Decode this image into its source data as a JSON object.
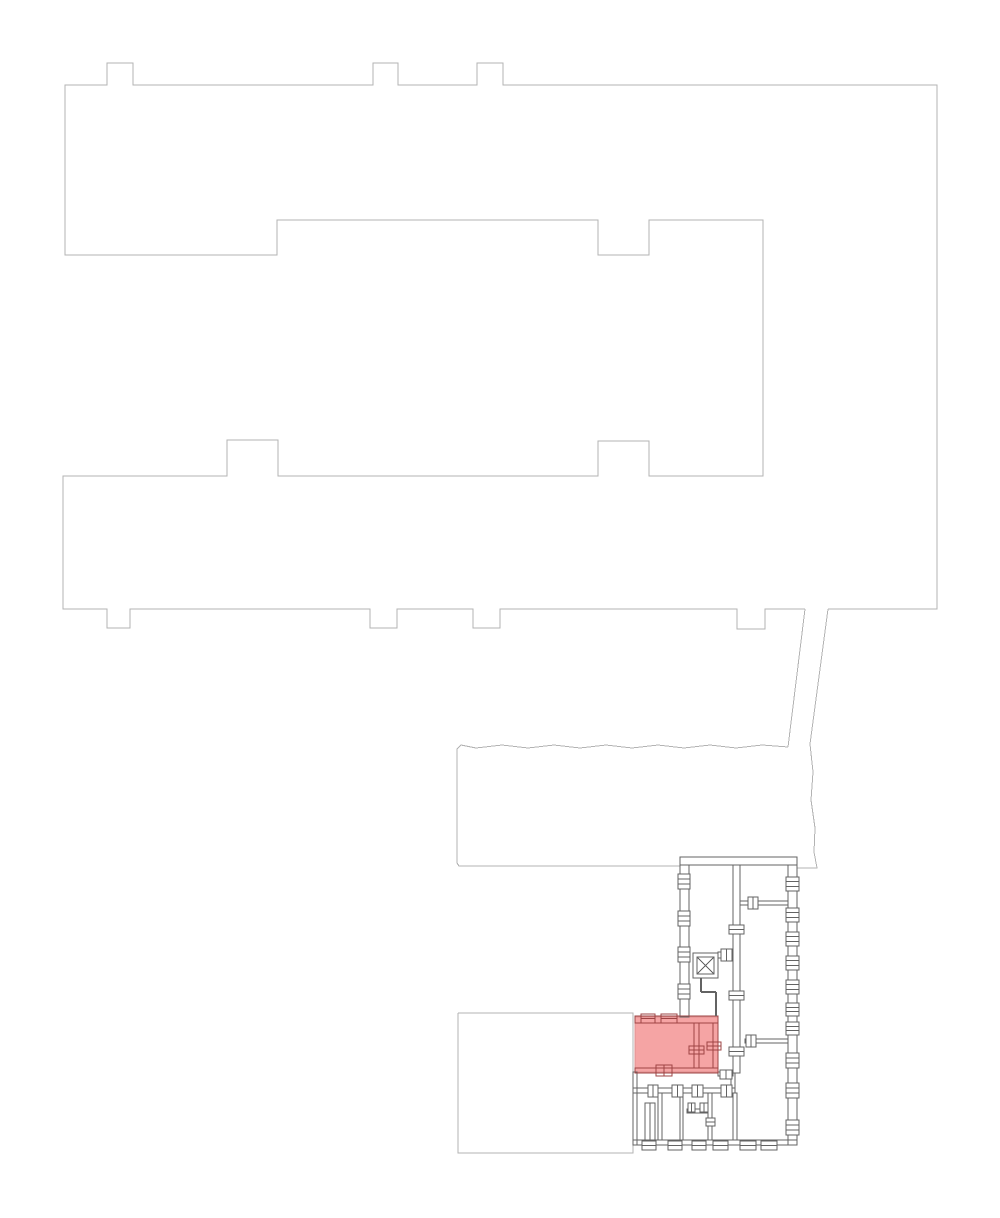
{
  "plan": {
    "canvas": {
      "width": 1000,
      "height": 1218,
      "background": "#ffffff"
    },
    "colors": {
      "outline": "#b3b3b3",
      "wall": "#636363",
      "highlight_wall": "#9e4444",
      "highlight_fill": "#f5a4a4",
      "highlight_edge": "#dd8f8f",
      "background": "#ffffff"
    },
    "outlines": [
      {
        "name": "main-building-outline",
        "points": [
          [
            828,
            609
          ],
          [
            937,
            609
          ],
          [
            937,
            85
          ],
          [
            503,
            85
          ],
          [
            503,
            63
          ],
          [
            477,
            63
          ],
          [
            477,
            85
          ],
          [
            398,
            85
          ],
          [
            398,
            63
          ],
          [
            373,
            63
          ],
          [
            373,
            85
          ],
          [
            133,
            85
          ],
          [
            133,
            63
          ],
          [
            107,
            63
          ],
          [
            107,
            85
          ],
          [
            65,
            85
          ],
          [
            65,
            255
          ],
          [
            277,
            255
          ],
          [
            277,
            220
          ],
          [
            598,
            220
          ],
          [
            598,
            255
          ],
          [
            649,
            255
          ],
          [
            649,
            220
          ],
          [
            763,
            220
          ],
          [
            763,
            476
          ],
          [
            649,
            476
          ],
          [
            649,
            441
          ],
          [
            598,
            441
          ],
          [
            598,
            476
          ],
          [
            278,
            476
          ],
          [
            278,
            440
          ],
          [
            227,
            440
          ],
          [
            227,
            476
          ],
          [
            63,
            476
          ],
          [
            63,
            609
          ],
          [
            107,
            609
          ],
          [
            107,
            628
          ],
          [
            130,
            628
          ],
          [
            130,
            609
          ],
          [
            370,
            609
          ],
          [
            370,
            628
          ],
          [
            397,
            628
          ],
          [
            397,
            609
          ],
          [
            473,
            609
          ],
          [
            473,
            628
          ],
          [
            500,
            628
          ],
          [
            500,
            609
          ],
          [
            737,
            609
          ],
          [
            737,
            629
          ],
          [
            765,
            629
          ],
          [
            765,
            609
          ],
          [
            805,
            609
          ]
        ]
      },
      {
        "name": "connector-left-line",
        "points": [
          [
            805,
            609
          ],
          [
            788,
            747
          ]
        ]
      },
      {
        "name": "connector-right-line",
        "points": [
          [
            828,
            609
          ],
          [
            810,
            744
          ]
        ]
      },
      {
        "name": "hall-outline",
        "points": [
          [
            788,
            747
          ],
          [
            762,
            745
          ],
          [
            736,
            748
          ],
          [
            710,
            745
          ],
          [
            684,
            748
          ],
          [
            658,
            745
          ],
          [
            632,
            748
          ],
          [
            606,
            745
          ],
          [
            580,
            748
          ],
          [
            554,
            745
          ],
          [
            528,
            748
          ],
          [
            502,
            745
          ],
          [
            476,
            748
          ],
          [
            461,
            745
          ],
          [
            457,
            749
          ],
          [
            457,
            863
          ],
          [
            459,
            866
          ],
          [
            680,
            866
          ]
        ]
      },
      {
        "name": "hall-right-edge",
        "points": [
          [
            810,
            744
          ],
          [
            813,
            772
          ],
          [
            811,
            800
          ],
          [
            815,
            828
          ],
          [
            814,
            852
          ],
          [
            817,
            868
          ],
          [
            797,
            868
          ]
        ]
      },
      {
        "name": "annex-outline",
        "points": [
          [
            458,
            1013
          ],
          [
            633,
            1013
          ],
          [
            633,
            1153
          ],
          [
            458,
            1153
          ],
          [
            458,
            1013
          ]
        ]
      }
    ],
    "walls": [
      {
        "name": "plan-top-wall",
        "x": 680,
        "y": 857,
        "w": 117,
        "h": 8
      },
      {
        "name": "plan-left-wall",
        "x": 680,
        "y": 865,
        "w": 9,
        "h": 152
      },
      {
        "name": "plan-right-wall",
        "x": 788,
        "y": 865,
        "w": 9,
        "h": 280
      },
      {
        "name": "plan-interior-wall",
        "x": 733,
        "y": 865,
        "w": 7,
        "h": 208
      },
      {
        "name": "room-divider-wall",
        "x": 740,
        "y": 901,
        "w": 48,
        "h": 4
      },
      {
        "name": "room-divider-wall",
        "x": 745,
        "y": 1039,
        "w": 43,
        "h": 4
      },
      {
        "name": "plan-interior-wall",
        "x": 731,
        "y": 1073,
        "w": 4,
        "h": 20
      },
      {
        "name": "corridor-wall",
        "x": 633,
        "y": 1088,
        "w": 102,
        "h": 5
      },
      {
        "name": "lower-left-wall",
        "x": 633,
        "y": 1072,
        "w": 4,
        "h": 73
      },
      {
        "name": "plan-bottom-wall",
        "x": 633,
        "y": 1140,
        "w": 164,
        "h": 5
      },
      {
        "name": "room-divider-wall",
        "x": 658,
        "y": 1093,
        "w": 4,
        "h": 47
      },
      {
        "name": "room-divider-wall",
        "x": 680,
        "y": 1093,
        "w": 3,
        "h": 47
      },
      {
        "name": "room-divider-wall",
        "x": 708,
        "y": 1093,
        "w": 4,
        "h": 47
      },
      {
        "name": "room-divider-wall",
        "x": 733,
        "y": 1093,
        "w": 4,
        "h": 47
      },
      {
        "name": "stair-closet-wall",
        "x": 645,
        "y": 1103,
        "w": 10,
        "h": 37
      },
      {
        "name": "closet-wall",
        "x": 687,
        "y": 1109,
        "w": 21,
        "h": 4
      },
      {
        "name": "elevator-link-wall",
        "x": 718,
        "y": 952,
        "w": 15,
        "h": 6
      },
      {
        "name": "interior-wall",
        "x": 718,
        "y": 1072,
        "w": 15,
        "h": 4
      },
      {
        "name": "highlight-top-wall",
        "x": 635,
        "y": 1016,
        "w": 83,
        "h": 7,
        "c": "highlight_wall"
      },
      {
        "name": "highlight-bottom-wall",
        "x": 635,
        "y": 1068,
        "w": 83,
        "h": 5,
        "c": "highlight_wall"
      },
      {
        "name": "highlight-interior-wall",
        "x": 694,
        "y": 1023,
        "w": 5,
        "h": 45,
        "c": "highlight_wall"
      },
      {
        "name": "highlight-right-wall",
        "x": 713,
        "y": 1023,
        "w": 5,
        "h": 45,
        "c": "highlight_wall"
      }
    ],
    "lines": [
      {
        "name": "elevator-lobby-wall",
        "x1": 701,
        "y1": 978,
        "x2": 701,
        "y2": 992,
        "sw": 1.6
      },
      {
        "name": "elevator-lobby-wall",
        "x1": 701,
        "y1": 992,
        "x2": 716,
        "y2": 992,
        "sw": 1.6
      },
      {
        "name": "elevator-lobby-wall",
        "x1": 716,
        "y1": 992,
        "x2": 716,
        "y2": 1016,
        "sw": 1.6
      },
      {
        "name": "stair-closet-line",
        "x1": 650,
        "y1": 1103,
        "x2": 650,
        "y2": 1140,
        "sw": 1
      }
    ],
    "hatches": [
      {
        "name": "window-hatch",
        "x": 678,
        "y": 874,
        "w": 12,
        "h": 15,
        "axis": "x",
        "n": 2,
        "fill": "#ffffff"
      },
      {
        "name": "window-hatch",
        "x": 678,
        "y": 911,
        "w": 12,
        "h": 15,
        "axis": "x",
        "n": 2,
        "fill": "#ffffff"
      },
      {
        "name": "window-hatch",
        "x": 678,
        "y": 947,
        "w": 12,
        "h": 15,
        "axis": "x",
        "n": 2,
        "fill": "#ffffff"
      },
      {
        "name": "window-hatch",
        "x": 678,
        "y": 984,
        "w": 12,
        "h": 15,
        "axis": "x",
        "n": 2,
        "fill": "#ffffff"
      },
      {
        "name": "window-hatch",
        "x": 786,
        "y": 877,
        "w": 13,
        "h": 14,
        "axis": "x",
        "n": 2,
        "fill": "#ffffff"
      },
      {
        "name": "window-hatch",
        "x": 786,
        "y": 908,
        "w": 13,
        "h": 14,
        "axis": "x",
        "n": 2,
        "fill": "#ffffff"
      },
      {
        "name": "window-hatch",
        "x": 786,
        "y": 932,
        "w": 13,
        "h": 14,
        "axis": "x",
        "n": 2,
        "fill": "#ffffff"
      },
      {
        "name": "window-hatch",
        "x": 786,
        "y": 956,
        "w": 13,
        "h": 14,
        "axis": "x",
        "n": 2,
        "fill": "#ffffff"
      },
      {
        "name": "window-hatch",
        "x": 786,
        "y": 980,
        "w": 13,
        "h": 14,
        "axis": "x",
        "n": 2,
        "fill": "#ffffff"
      },
      {
        "name": "window-hatch",
        "x": 786,
        "y": 1003,
        "w": 13,
        "h": 13,
        "axis": "x",
        "n": 2,
        "fill": "#ffffff"
      },
      {
        "name": "window-hatch",
        "x": 786,
        "y": 1022,
        "w": 13,
        "h": 13,
        "axis": "x",
        "n": 2,
        "fill": "#ffffff"
      },
      {
        "name": "window-hatch",
        "x": 786,
        "y": 1053,
        "w": 13,
        "h": 15,
        "axis": "x",
        "n": 2,
        "fill": "#ffffff"
      },
      {
        "name": "window-hatch",
        "x": 786,
        "y": 1083,
        "w": 13,
        "h": 15,
        "axis": "x",
        "n": 2,
        "fill": "#ffffff"
      },
      {
        "name": "window-hatch",
        "x": 786,
        "y": 1120,
        "w": 13,
        "h": 15,
        "axis": "x",
        "n": 2,
        "fill": "#ffffff"
      },
      {
        "name": "door-hatch",
        "x": 748,
        "y": 897,
        "w": 10,
        "h": 12,
        "axis": "y",
        "n": 1,
        "fill": "#ffffff"
      },
      {
        "name": "door-hatch",
        "x": 746,
        "y": 1035,
        "w": 10,
        "h": 12,
        "axis": "y",
        "n": 1,
        "fill": "#ffffff"
      },
      {
        "name": "door-hatch",
        "x": 721,
        "y": 949,
        "w": 11,
        "h": 12,
        "axis": "y",
        "n": 1,
        "fill": "#ffffff"
      },
      {
        "name": "door-hatch",
        "x": 729,
        "y": 925,
        "w": 15,
        "h": 9,
        "axis": "x",
        "n": 1,
        "fill": "#ffffff"
      },
      {
        "name": "door-hatch",
        "x": 729,
        "y": 991,
        "w": 15,
        "h": 9,
        "axis": "x",
        "n": 1,
        "fill": "#ffffff"
      },
      {
        "name": "door-hatch",
        "x": 729,
        "y": 1047,
        "w": 15,
        "h": 9,
        "axis": "x",
        "n": 1,
        "fill": "#ffffff"
      },
      {
        "name": "door-hatch",
        "x": 648,
        "y": 1085,
        "w": 10,
        "h": 12,
        "axis": "y",
        "n": 1,
        "fill": "#ffffff"
      },
      {
        "name": "door-hatch",
        "x": 672,
        "y": 1085,
        "w": 11,
        "h": 12,
        "axis": "y",
        "n": 1,
        "fill": "#ffffff"
      },
      {
        "name": "door-hatch",
        "x": 692,
        "y": 1085,
        "w": 11,
        "h": 12,
        "axis": "y",
        "n": 1,
        "fill": "#ffffff"
      },
      {
        "name": "door-hatch",
        "x": 721,
        "y": 1085,
        "w": 11,
        "h": 12,
        "axis": "y",
        "n": 1,
        "fill": "#ffffff"
      },
      {
        "name": "window-hatch",
        "x": 642,
        "y": 1141,
        "w": 14,
        "h": 9,
        "axis": "x",
        "n": 1,
        "fill": "#ffffff"
      },
      {
        "name": "window-hatch",
        "x": 668,
        "y": 1141,
        "w": 14,
        "h": 9,
        "axis": "x",
        "n": 1,
        "fill": "#ffffff"
      },
      {
        "name": "window-hatch",
        "x": 692,
        "y": 1141,
        "w": 14,
        "h": 9,
        "axis": "x",
        "n": 1,
        "fill": "#ffffff"
      },
      {
        "name": "window-hatch",
        "x": 713,
        "y": 1141,
        "w": 15,
        "h": 9,
        "axis": "x",
        "n": 1,
        "fill": "#ffffff"
      },
      {
        "name": "window-hatch",
        "x": 740,
        "y": 1141,
        "w": 16,
        "h": 9,
        "axis": "x",
        "n": 1,
        "fill": "#ffffff"
      },
      {
        "name": "window-hatch",
        "x": 761,
        "y": 1141,
        "w": 16,
        "h": 9,
        "axis": "x",
        "n": 1,
        "fill": "#ffffff"
      },
      {
        "name": "door-hatch",
        "x": 688,
        "y": 1103,
        "w": 7,
        "h": 9,
        "axis": "y",
        "n": 1,
        "fill": "#ffffff"
      },
      {
        "name": "door-hatch",
        "x": 700,
        "y": 1103,
        "w": 8,
        "h": 9,
        "axis": "y",
        "n": 1,
        "fill": "#ffffff"
      },
      {
        "name": "door-hatch",
        "x": 706,
        "y": 1118,
        "w": 9,
        "h": 8,
        "axis": "x",
        "n": 1,
        "fill": "#ffffff"
      },
      {
        "name": "door-hatch",
        "x": 720,
        "y": 1070,
        "w": 12,
        "h": 9,
        "axis": "y",
        "n": 1,
        "fill": "#ffffff"
      },
      {
        "name": "window-hatch",
        "x": 641,
        "y": 1014,
        "w": 14,
        "h": 9,
        "axis": "x",
        "n": 1,
        "c": "highlight_wall",
        "fill": "none"
      },
      {
        "name": "window-hatch",
        "x": 661,
        "y": 1014,
        "w": 16,
        "h": 9,
        "axis": "x",
        "n": 1,
        "c": "highlight_wall",
        "fill": "none"
      },
      {
        "name": "door-hatch",
        "x": 656,
        "y": 1065,
        "w": 16,
        "h": 11,
        "axis": "y",
        "n": 1,
        "c": "highlight_wall",
        "fill": "none"
      },
      {
        "name": "door-hatch",
        "x": 689,
        "y": 1046,
        "w": 15,
        "h": 8,
        "axis": "x",
        "n": 1,
        "c": "highlight_wall",
        "fill": "none"
      },
      {
        "name": "door-hatch",
        "x": 707,
        "y": 1042,
        "w": 14,
        "h": 8,
        "axis": "x",
        "n": 1,
        "c": "highlight_wall",
        "fill": "none"
      }
    ],
    "elevator": {
      "outer": {
        "x": 693,
        "y": 953,
        "w": 25,
        "h": 25
      },
      "inner": {
        "x": 697,
        "y": 957,
        "w": 17,
        "h": 17
      }
    },
    "highlight": {
      "name": "highlighted-room",
      "x": 635,
      "y": 1017,
      "w": 83,
      "h": 55
    }
  }
}
